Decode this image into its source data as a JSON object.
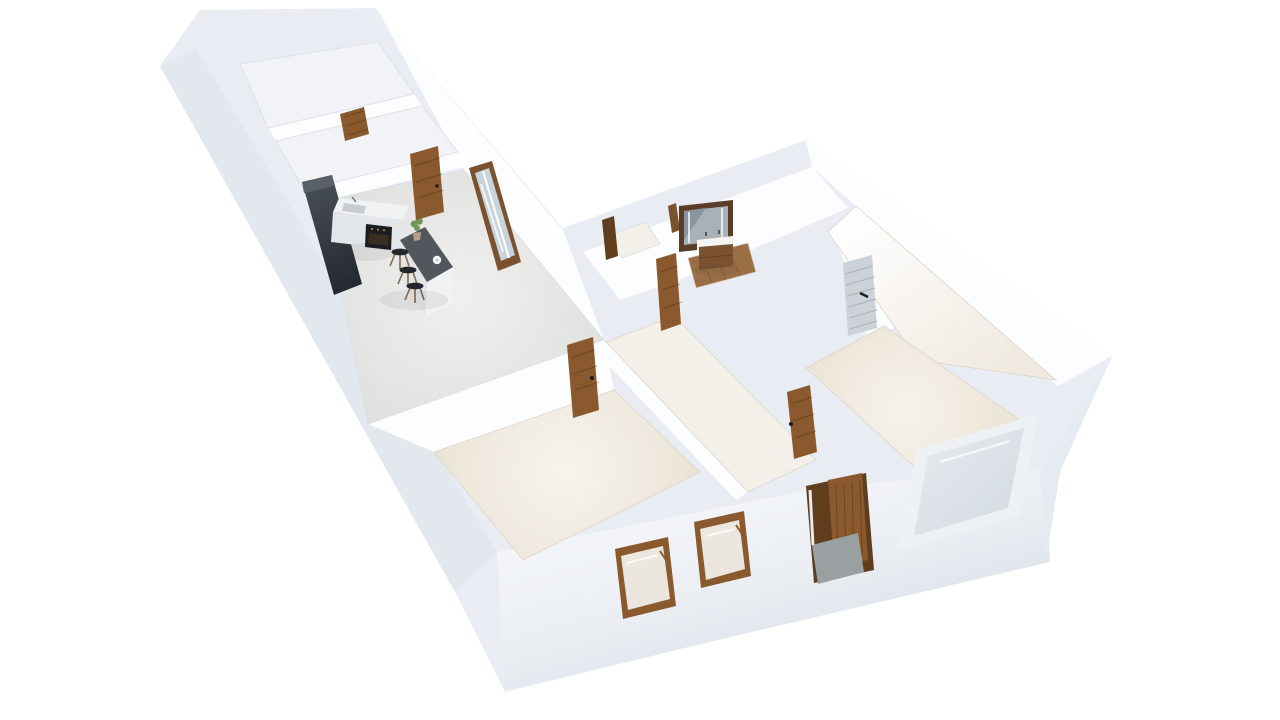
{
  "scene": {
    "kind": "3d-floor-plan-render",
    "view": "isometric birds-eye perspective, white background",
    "building": "L-shaped single-storey apartment with open walls (doll-house cutaway)",
    "rooms": [
      {
        "name": "storage-room-top"
      },
      {
        "name": "storage-room-second"
      },
      {
        "name": "kitchen-living-room"
      },
      {
        "name": "bedroom-left"
      },
      {
        "name": "wc"
      },
      {
        "name": "bathroom"
      },
      {
        "name": "hallway"
      },
      {
        "name": "bedroom-right"
      },
      {
        "name": "utility-room"
      },
      {
        "name": "entrance"
      }
    ],
    "furniture": [
      {
        "name": "tall-kitchen-cabinet"
      },
      {
        "name": "kitchen-counter-with-sink-and-oven"
      },
      {
        "name": "kitchen-island-with-plant-and-kettle"
      },
      {
        "name": "bar-stools",
        "count": 3
      },
      {
        "name": "bathroom-vanity-with-double-sink"
      },
      {
        "name": "bathroom-mirror-with-lights"
      }
    ],
    "openings": [
      {
        "name": "interior-wood-doors",
        "count": 7
      },
      {
        "name": "white-slatted-door",
        "count": 1
      },
      {
        "name": "front-entrance-door"
      },
      {
        "name": "sliding-glass-door"
      },
      {
        "name": "street-windows",
        "count": 2
      },
      {
        "name": "large-frosted-window"
      }
    ]
  },
  "colors": {
    "bg": "#ffffff",
    "shell": "#e9edf3",
    "shell_shade": "#e3e8ef",
    "se_wedge": "#e6ebf1",
    "wall_bright": "#fcfdfe",
    "floor_small_room": "#f1f3f6",
    "floor_pale": "#f3f0ea",
    "bath_wood": "#9a6f45",
    "door_wood": "#8a5a2e",
    "door_wood_dark": "#5f3d1d",
    "slat_door": "#ccd2d8",
    "cabinet_dark": "#2c323a",
    "cabinet_top": "#596069",
    "island_top": "#52575e",
    "counter": "#f1f2f4",
    "counter_side": "#e3e6e9",
    "sink": "#c7ccd1",
    "oven": "#1a1d21",
    "oven_glow": "#d08b3e",
    "stool_seat": "#23272c",
    "stool_leg": "#8a6a45",
    "plant": "#6f9955",
    "plant_pot": "#b3a18e",
    "glass": "#c9d3da",
    "window_frame_white": "#eef1f4",
    "mirror_frame": "#5a3d26",
    "mirror_glass": "#a9b1b8",
    "mirror_shade": "#8b959e",
    "vanity_wood": "#7a5230",
    "vanity_top": "#f4f4f4",
    "tile": "#9aa0a2",
    "handle": "#1b1b1b",
    "window_interior": "#ece7de",
    "kettle": "#f5f6f7"
  }
}
